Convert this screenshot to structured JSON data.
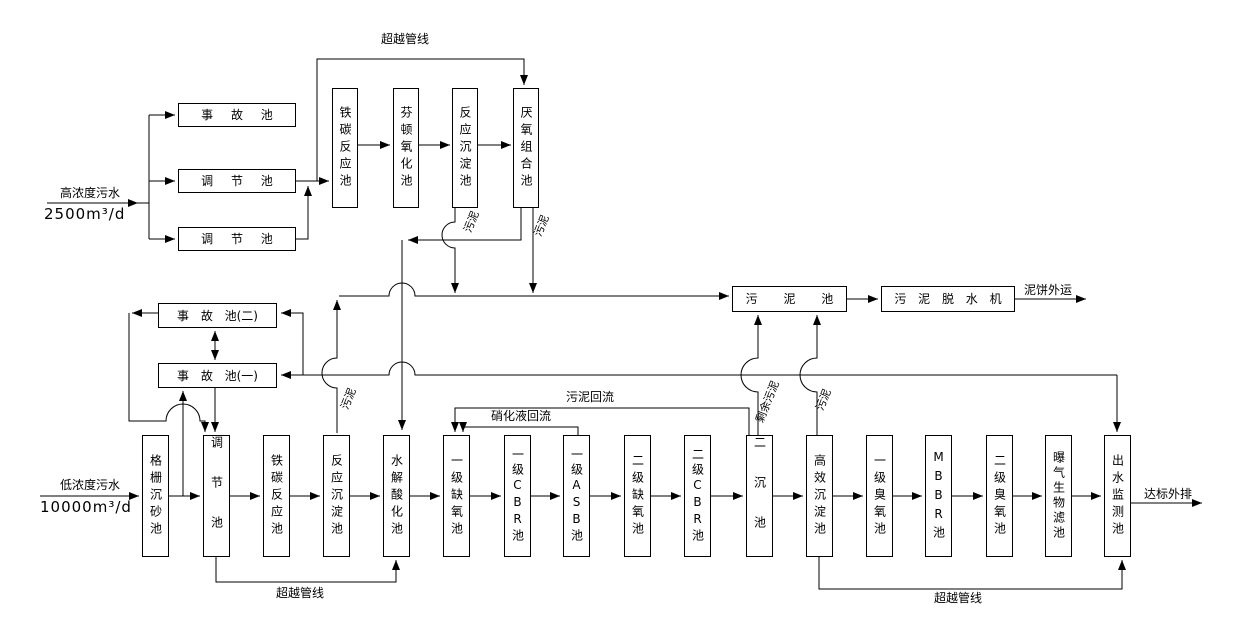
{
  "diagram": {
    "inlet_high": {
      "label": "高浓度污水",
      "flow": "2500m³/d"
    },
    "inlet_low": {
      "label": "低浓度污水",
      "flow": "10000m³/d"
    },
    "pre_tanks": {
      "accident": "事 故 池",
      "regulating_1": "调 节 池",
      "regulating_2": "调 节 池"
    },
    "top_row": [
      "铁碳反应池",
      "芬顿氧化池",
      "反应沉淀池",
      "厌氧组合池"
    ],
    "emergency_tanks": {
      "tank2": "事 故 池(二)",
      "tank1": "事 故 池(一)"
    },
    "sludge_section": {
      "sludge_tank": "污 泥 池",
      "dewatering": "污 泥 脱 水 机",
      "cake_label": "泥饼外运"
    },
    "bottom_row": [
      "格栅沉砂池",
      "调节池",
      "铁碳反应池",
      "反应沉淀池",
      "水解酸化池",
      "一级缺氧池",
      "一级CBR池",
      "一级ASB池",
      "二级缺氧池",
      "二级CBR池",
      "二沉池",
      "高效沉淀池",
      "一级臭氧池",
      "MBBR池",
      "二级臭氧池",
      "曝气生物滤池",
      "出水监测池"
    ],
    "line_labels": {
      "bypass_top": "超越管线",
      "bypass_low": "超越管线",
      "bypass_out": "超越管线",
      "sludge_return": "污泥回流",
      "nitrified_return": "硝化液回流",
      "surplus_sludge": "剩余污泥",
      "sludge": "污泥",
      "discharge": "达标外排"
    }
  }
}
